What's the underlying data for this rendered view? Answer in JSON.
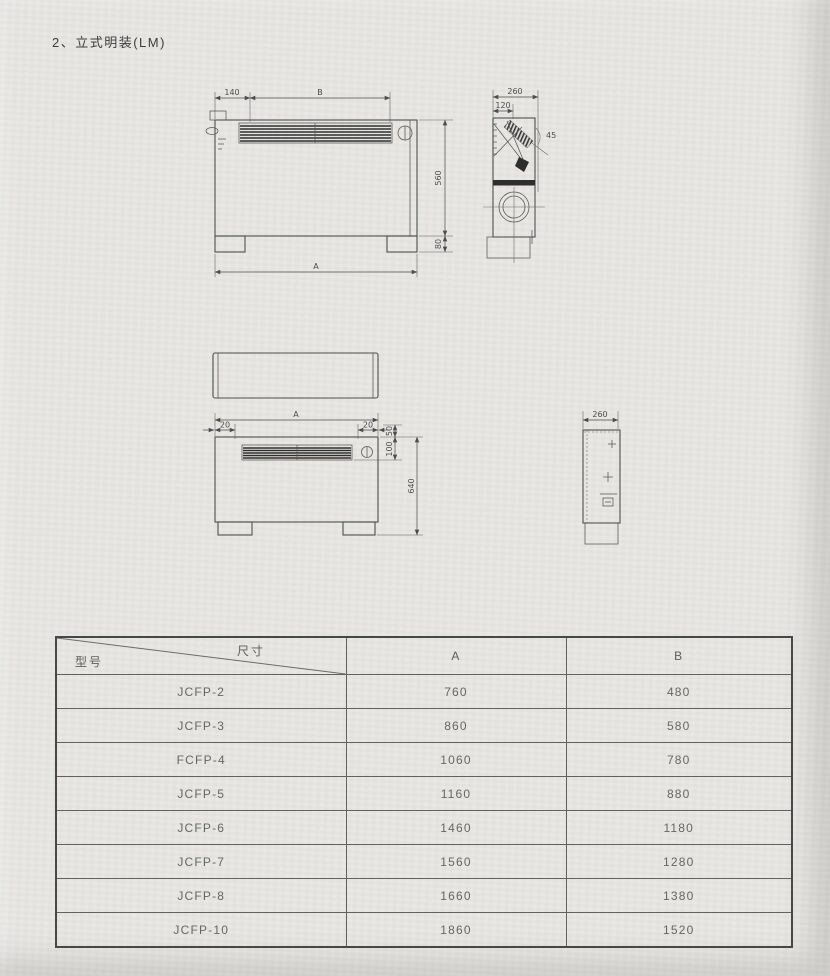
{
  "page": {
    "title": "2、立式明装(LM)"
  },
  "drawings": {
    "front_top": {
      "offset": "140",
      "width_b": "B",
      "height_body": "560",
      "height_feet": "80",
      "width_a": "A"
    },
    "side_top": {
      "depth": "260",
      "lip": "120",
      "angle": "45"
    },
    "front_bottom": {
      "width_a": "A",
      "margin_left": "20",
      "margin_right": "20",
      "gap_top": "50",
      "grille_height": "100",
      "height_total": "640"
    },
    "side_bottom": {
      "depth": "260"
    }
  },
  "table": {
    "header": {
      "model": "型号",
      "dim": "尺寸",
      "col_a": "A",
      "col_b": "B"
    },
    "rows": [
      {
        "model": "JCFP-2",
        "a": "760",
        "b": "480"
      },
      {
        "model": "JCFP-3",
        "a": "860",
        "b": "580"
      },
      {
        "model": "FCFP-4",
        "a": "1060",
        "b": "780"
      },
      {
        "model": "JCFP-5",
        "a": "1160",
        "b": "880"
      },
      {
        "model": "JCFP-6",
        "a": "1460",
        "b": "1180"
      },
      {
        "model": "JCFP-7",
        "a": "1560",
        "b": "1280"
      },
      {
        "model": "JCFP-8",
        "a": "1660",
        "b": "1380"
      },
      {
        "model": "JCFP-10",
        "a": "1860",
        "b": "1520"
      }
    ]
  },
  "colors": {
    "paper": "#e8e7e4",
    "ink": "#4d4d4d",
    "table_line": "#5e5e5e"
  }
}
